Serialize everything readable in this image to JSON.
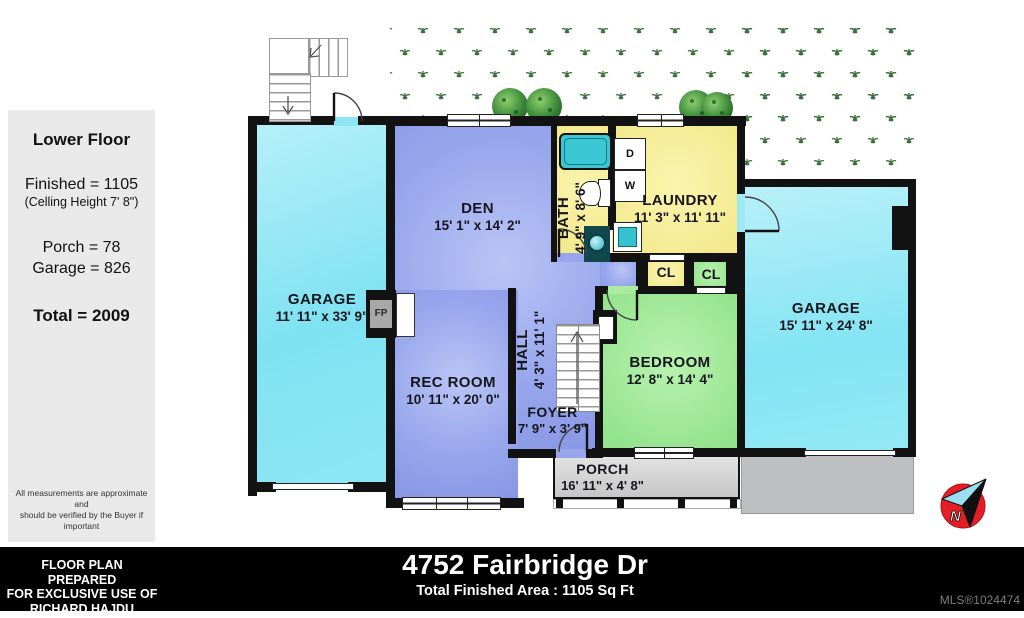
{
  "sidebar": {
    "title": "Lower Floor",
    "finished": "Finished = 1105",
    "ceiling": "(Celling Height 7' 8\")",
    "porch": "Porch = 78",
    "garage": "Garage = 826",
    "total": "Total = 2009",
    "disclaimer_line1": "All measurements are approximate and",
    "disclaimer_line2": "should be verified by the Buyer if important"
  },
  "footer": {
    "prepared_line1": "FLOOR PLAN PREPARED",
    "prepared_line2": "FOR EXCLUSIVE USE OF",
    "prepared_line3": "RICHARD HAJDU",
    "address": "4752 Fairbridge Dr",
    "total_area": "Total Finished Area : 1105 Sq Ft",
    "mls": "MLS®1024474"
  },
  "rooms": {
    "garage_left": {
      "name": "GARAGE",
      "dims": "11' 11\" x 33' 9\""
    },
    "den": {
      "name": "DEN",
      "dims": "15' 1\" x 14' 2\""
    },
    "bath": {
      "name": "BATH",
      "dims": "4' 9\" x 8' 6\""
    },
    "laundry": {
      "name": "LAUNDRY",
      "dims": "11' 3\" x 11' 11\""
    },
    "garage_right": {
      "name": "GARAGE",
      "dims": "15' 11\" x 24' 8\""
    },
    "rec_room": {
      "name": "REC ROOM",
      "dims": "10' 11\" x 20' 0\""
    },
    "hall": {
      "name": "HALL",
      "dims": "4' 3\" x 11' 1\""
    },
    "bedroom": {
      "name": "BEDROOM",
      "dims": "12' 8\" x 14' 4\""
    },
    "foyer": {
      "name": "FOYER",
      "dims": "7' 9\" x 3' 9\""
    },
    "porch": {
      "name": "PORCH",
      "dims": "16' 11\" x 4' 8\""
    },
    "closet_laundry": {
      "label": "CL"
    },
    "closet_bedroom": {
      "label": "CL"
    }
  },
  "fixtures": {
    "dryer_label": "D",
    "washer_label": "W",
    "fireplace_label": "FP"
  },
  "compass": {
    "north_label": "N"
  },
  "colors": {
    "garage_cyan": "#8ce6f3",
    "living_periwinkle": "#97a6ec",
    "wet_yellow": "#f3ea8f",
    "bedroom_green": "#9ce893",
    "porch_gray": "#d2d2d2",
    "wall_black": "#121212",
    "compass_red": "#e41e26",
    "grass_green": "#3a703a"
  }
}
